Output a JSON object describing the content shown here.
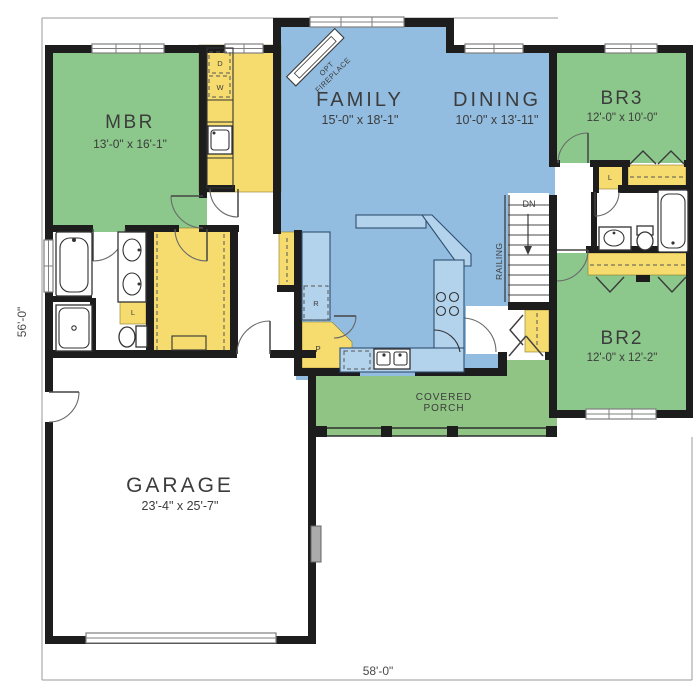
{
  "plan": {
    "dimension_height": "56'-0\"",
    "dimension_width": "58'-0\"",
    "rooms": {
      "mbr": {
        "name": "MBR",
        "size": "13'-0\" x 16'-1\""
      },
      "family": {
        "name": "FAMILY",
        "size": "15'-0\" x 18'-1\""
      },
      "dining": {
        "name": "DINING",
        "size": "10'-0\" x 13'-11\""
      },
      "br3": {
        "name": "BR3",
        "size": "12'-0\" x 10'-0\""
      },
      "br2": {
        "name": "BR2",
        "size": "12'-0\" x 12'-2\""
      },
      "garage": {
        "name": "GARAGE",
        "size": "23'-4\" x 25'-7\""
      },
      "porch": {
        "line1": "COVERED",
        "line2": "PORCH"
      }
    },
    "labels": {
      "fireplace_line1": "OPT",
      "fireplace_line2": "FIREPLACE",
      "stairs_down": "DN",
      "railing": "RAILING",
      "dryer": "D",
      "washer": "W",
      "refrigerator": "R",
      "pantry": "P",
      "linen_master": "L",
      "linen_hall": "L"
    },
    "colors": {
      "bedroom_green": "#8cc88c",
      "porch_green": "#8fc484",
      "living_blue": "#92bde0",
      "counter_blue": "#b3d2ec",
      "closet_yellow": "#f6dc6e",
      "wall_black": "#1d1d1d",
      "text_dark": "#3c3c3c",
      "dim_gray": "#9a9a9a"
    }
  }
}
